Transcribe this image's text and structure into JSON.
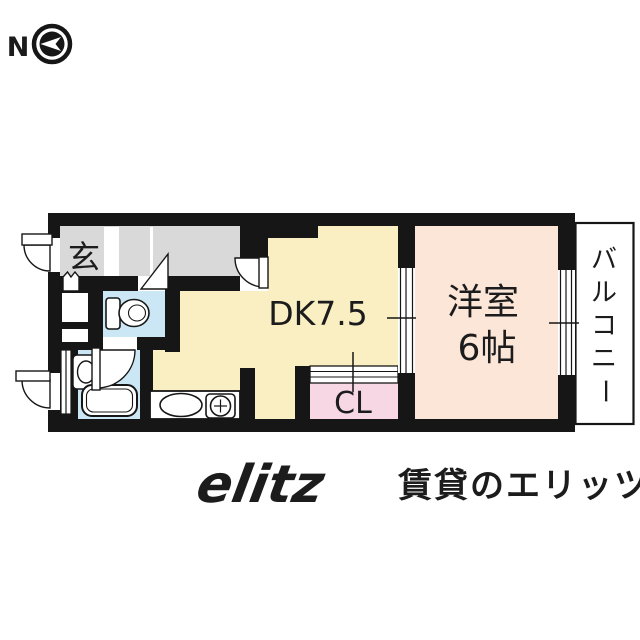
{
  "compass": {
    "north_label": "N"
  },
  "plan": {
    "entrance_label": "玄",
    "dk_label": "DK7.5",
    "closet_label": "CL",
    "western_room_label_1": "洋室",
    "western_room_label_2": "6帖",
    "balcony_label": "バルコニー",
    "balcony_chars": [
      "バ",
      "ル",
      "コ",
      "ニ",
      "ー"
    ],
    "colors": {
      "wall": "#161616",
      "hallway": "#d9d9d9",
      "dk": "#f9efc3",
      "western_room": "#fce6d8",
      "closet": "#f8d7e5",
      "wet_area": "#cbe7f5",
      "balcony": "#ffffff"
    },
    "fixtures": [
      "toilet",
      "bathtub",
      "washbasin",
      "kitchen-sink",
      "gas-stove",
      "shoe-cabinet",
      "sliding-window",
      "door-swing",
      "compass-north-arrow"
    ]
  },
  "watermark": {
    "logo_text": "elitz",
    "brand_text": "賃貸のエリッツ",
    "color": "#e5e3e3"
  }
}
